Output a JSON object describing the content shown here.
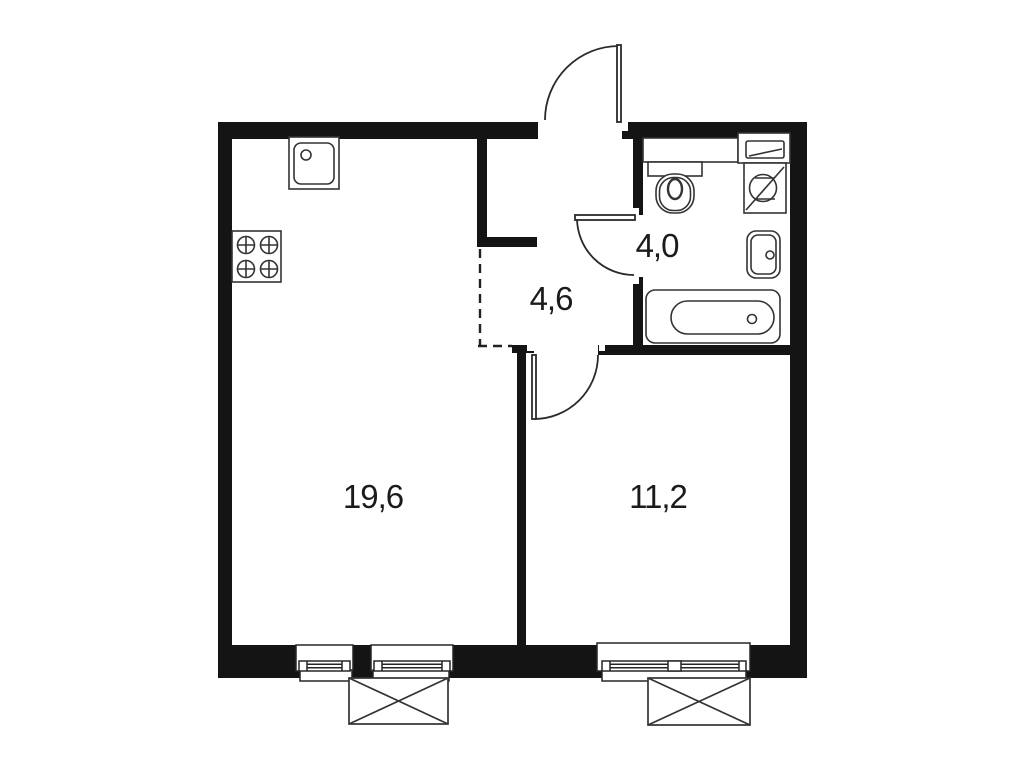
{
  "floor_plan": {
    "kind": "apartment-floor-plan",
    "rooms": [
      {
        "name": "living-kitchen",
        "area_label": "19,6"
      },
      {
        "name": "bedroom",
        "area_label": "11,2"
      },
      {
        "name": "hallway",
        "area_label": "4,6"
      },
      {
        "name": "bathroom",
        "area_label": "4,0"
      }
    ],
    "fixtures": [
      "kitchen-sink",
      "stove",
      "toilet",
      "shelf",
      "washing-machine",
      "washbasin",
      "bathtub",
      "entry-door",
      "bathroom-door",
      "bedroom-door",
      "window",
      "window",
      "window",
      "ac-basket",
      "ac-basket"
    ],
    "colors": {
      "wall": "#141414",
      "fixture_line": "#333333",
      "background": "#ffffff",
      "text": "#1b1b1b"
    }
  }
}
